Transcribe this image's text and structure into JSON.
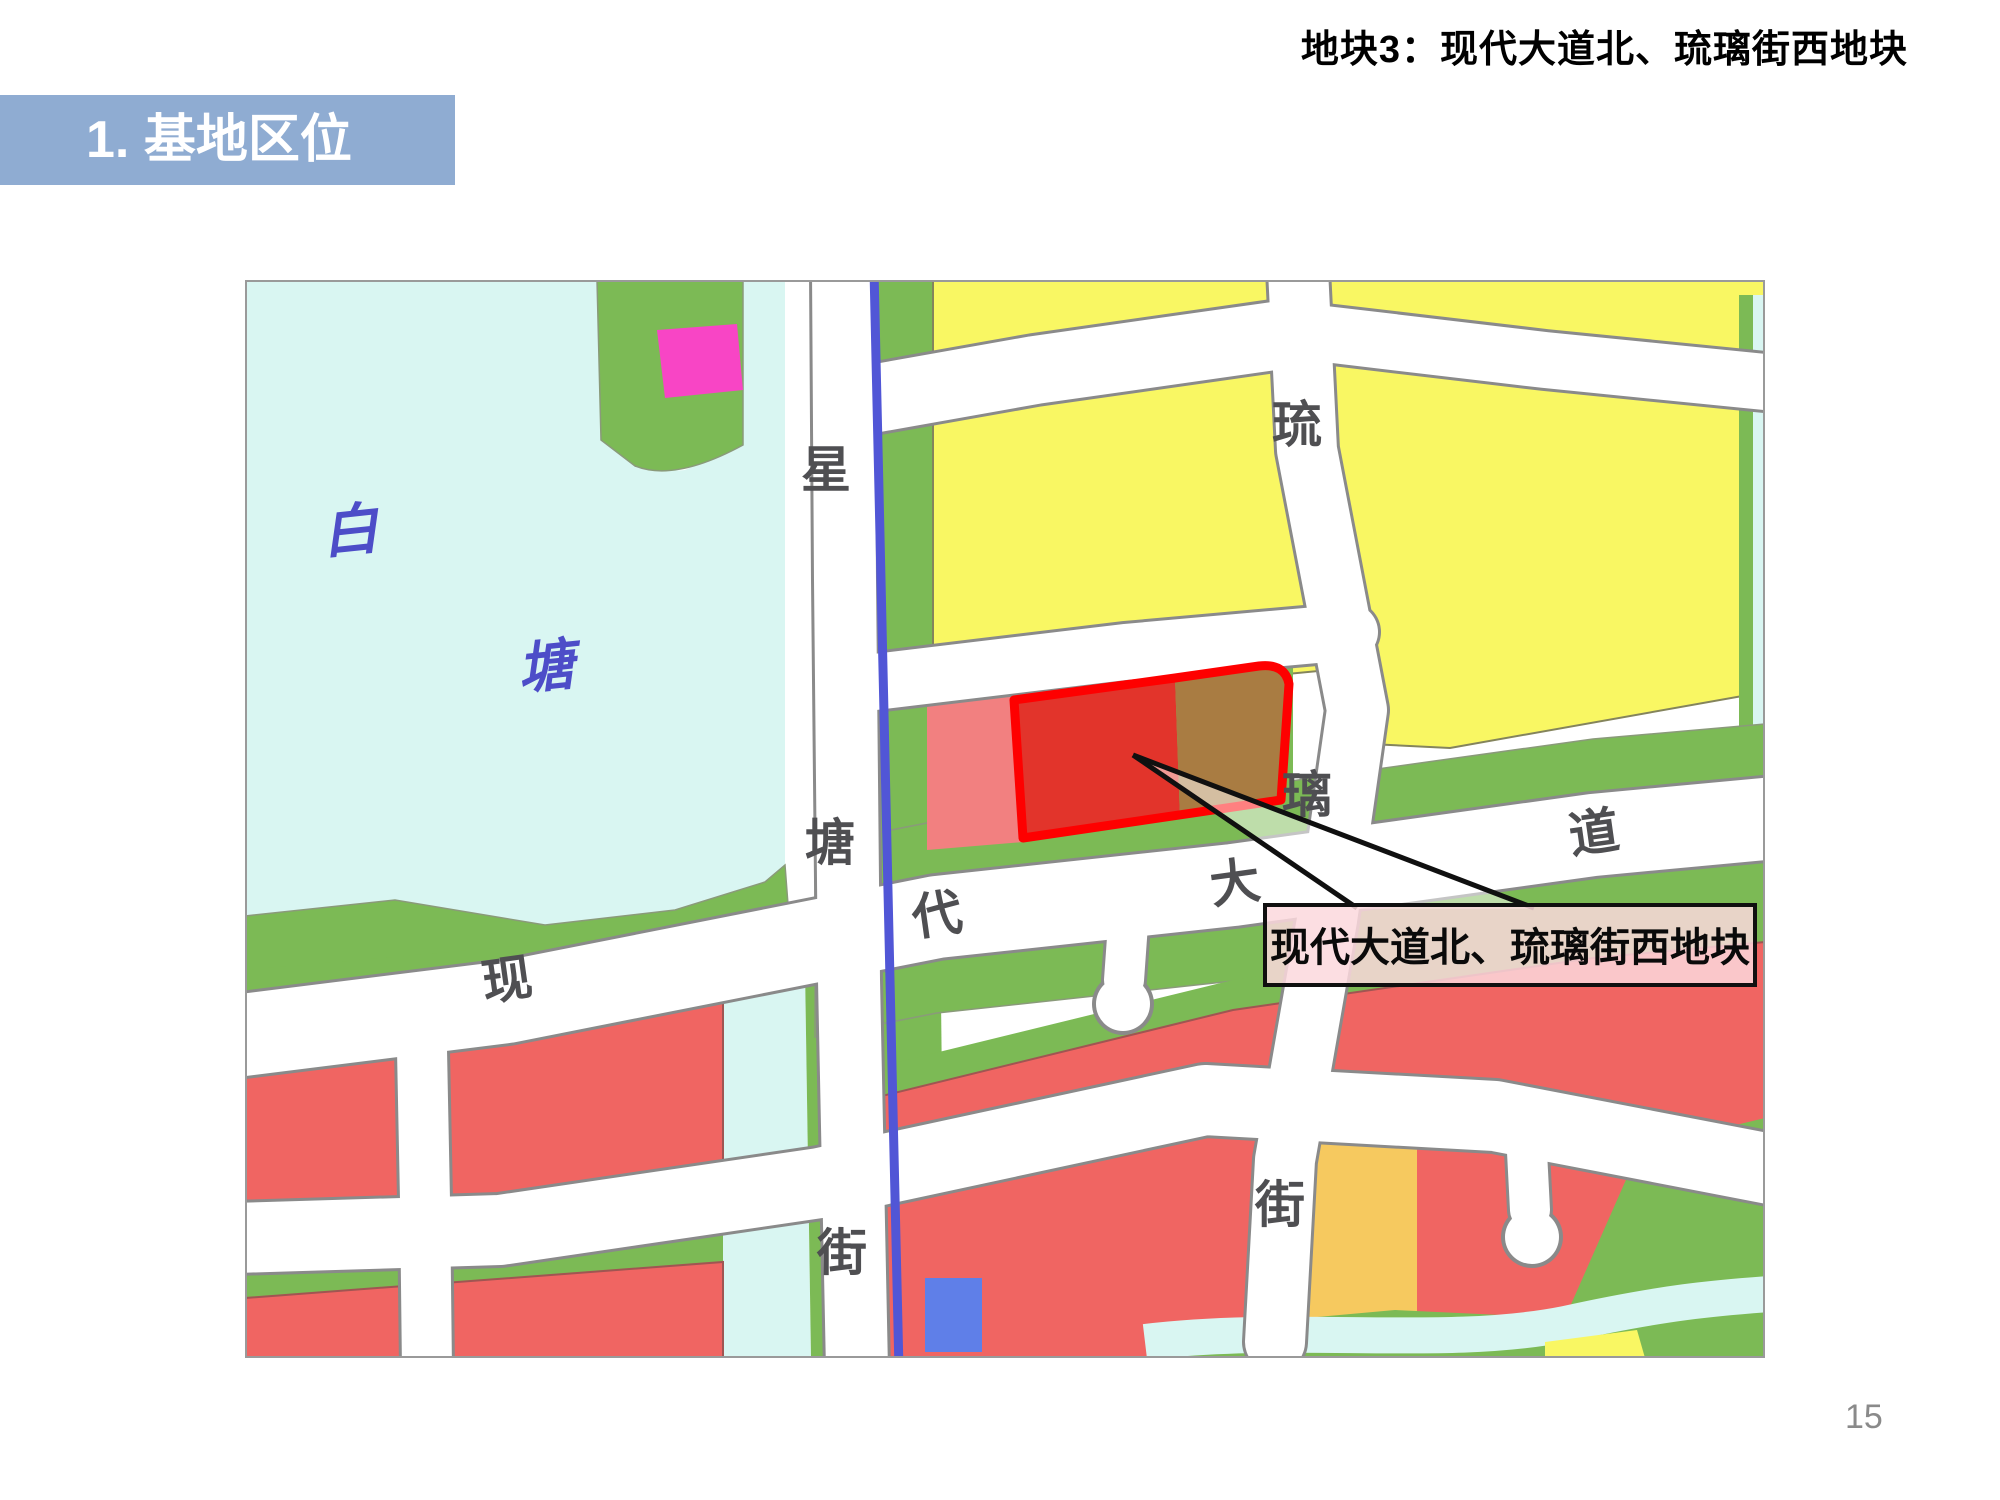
{
  "header": {
    "title": "地块3：现代大道北、琉璃街西地块"
  },
  "section": {
    "title": "1. 基地区位"
  },
  "footer": {
    "page_number": "15"
  },
  "map": {
    "water_label_chars": [
      "白",
      "塘"
    ],
    "streets": {
      "xingtang_street_name": "星塘街",
      "xingtang_street_chars": [
        "星",
        "塘",
        "街"
      ],
      "xiandai_avenue_name": "现代大道",
      "xiandai_avenue_chars": [
        "现",
        "代",
        "大",
        "道"
      ],
      "liuli_street_name": "琉璃街",
      "liuli_street_chars": [
        "琉",
        "璃",
        "街"
      ]
    },
    "callout_label": "现代大道北、琉璃街西地块",
    "palette": {
      "water": "#D9F6F2",
      "green_space": "#7CBA55",
      "yellow_block": "#F9F763",
      "red_block": "#F06562",
      "golden_block": "#F6C95F",
      "blue_block": "#5F7FE8",
      "magenta_block": "#F845C5",
      "river_line": "#5156D6",
      "parcel_outline": "#FE0000",
      "parcel_fill_left": "#E2342B",
      "parcel_fill_right": "#A97C42",
      "road": "#FFFFFF",
      "header_bar": "#8FACD2"
    }
  }
}
